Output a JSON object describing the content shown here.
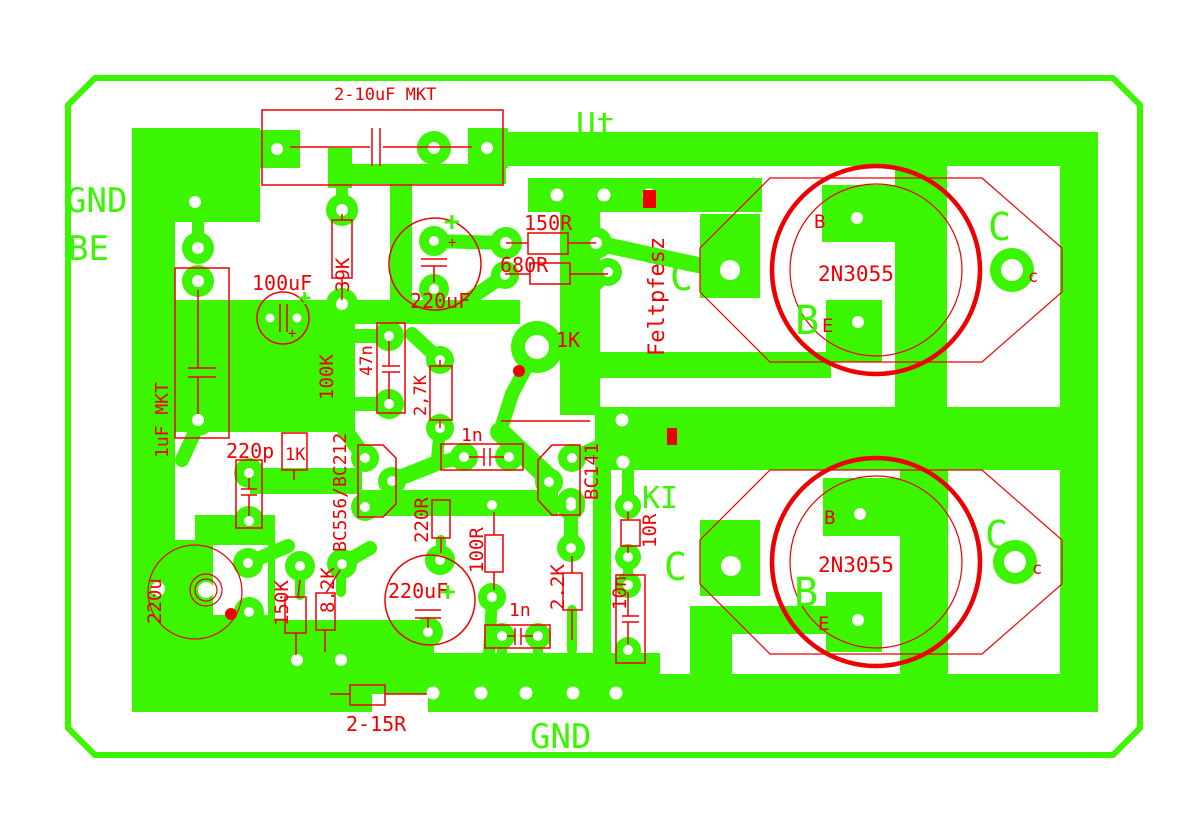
{
  "meta": {
    "description": "Printed circuit board layout artwork: green copper layer with pads and traces, red silkscreen component outlines and values",
    "colors": {
      "copper": "#3cf500",
      "silkscreen": "#ee0000",
      "background": "#ffffff"
    }
  },
  "labels": {
    "gnd_left": "GND",
    "be": "BE",
    "ut": "Ut",
    "ki": "KI",
    "gnd_bottom": "GND",
    "c_top_inner": "C",
    "c_top_outer": "C",
    "b_top": "B",
    "c_bot_inner": "C",
    "c_bot_outer": "C",
    "b_bot": "B",
    "plus_220uf_top": "+",
    "plus_100uf": "+",
    "plus_220uf_bot": "+",
    "silk": {
      "cap_input": "2-10uF MKT",
      "r_39k": "39K",
      "cap_100uf": "100uF",
      "r_150r": "150R",
      "r_680r": "680R",
      "cap_220uf_top": "220uF",
      "feltpfesz": "Feltpfesz",
      "q1": "2N3055",
      "q1_b": "B",
      "q1_e": "E",
      "q1_c": "c",
      "q2": "2N3055",
      "q2_b": "B",
      "q2_e": "E",
      "q2_c": "c",
      "cap_1uf": "1uF MKT",
      "r_100k": "100K",
      "cap_47n": "47n",
      "r_2k7": "2,7K",
      "r_1k_box": "1K",
      "r_1k_mid": "1K",
      "cap_220p": "220p",
      "q_bc556": "BC556/BC212",
      "q_bc141": "BC141",
      "cap_1n_top": "1n",
      "cap_1n_bot": "1n",
      "r_220r": "220R",
      "r_100r": "100R",
      "cap_220uf_bot": "220uF",
      "r_2k2": "2.2K",
      "r_10r": "10R",
      "cap_10n": "10n",
      "r_150k": "150K",
      "r_8k2": "8.2K",
      "cap_220u": "220u",
      "r_2_15r": "2-15R",
      "plus_220uf_top_small": "+",
      "plus_100uf_small": "+"
    }
  }
}
